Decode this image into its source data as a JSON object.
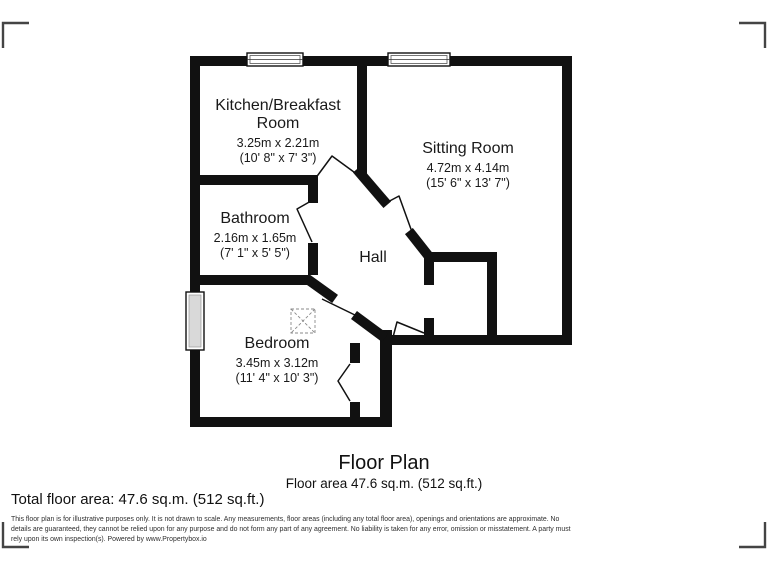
{
  "rooms": {
    "kitchen": {
      "lines": [
        "Kitchen/Breakfast",
        "Room"
      ],
      "metric": "3.25m x 2.21m",
      "imperial": "(10' 8\" x 7' 3\")"
    },
    "sitting": {
      "name": "Sitting Room",
      "metric": "4.72m x 4.14m",
      "imperial": "(15' 6\" x 13' 7\")"
    },
    "bathroom": {
      "name": "Bathroom",
      "metric": "2.16m x 1.65m",
      "imperial": "(7' 1\" x 5' 5\")"
    },
    "hall": {
      "name": "Hall"
    },
    "bedroom": {
      "name": "Bedroom",
      "metric": "3.45m x 3.12m",
      "imperial": "(11' 4\" x 10' 3\")"
    }
  },
  "footer": {
    "title": "Floor Plan",
    "subtitle": "Floor area 47.6 sq.m. (512 sq.ft.)",
    "total_area": "Total floor area: 47.6 sq.m. (512 sq.ft.)",
    "disclaimer": "This floor plan is for illustrative purposes only. It is not drawn to scale. Any measurements, floor areas (including any total floor area), openings and orientations are approximate. No details are guaranteed, they cannot be relied upon for any purpose and do not form any part of any agreement. No liability is taken for any error, omission or misstatement. A party must rely upon its own inspection(s). Powered by www.Propertybox.io"
  },
  "colors": {
    "wall": "#111111",
    "text": "#1a1a1a",
    "disclaimer_text": "#2f2f2f",
    "bracket": "#444444",
    "window_glass": "#d9d9d9"
  }
}
